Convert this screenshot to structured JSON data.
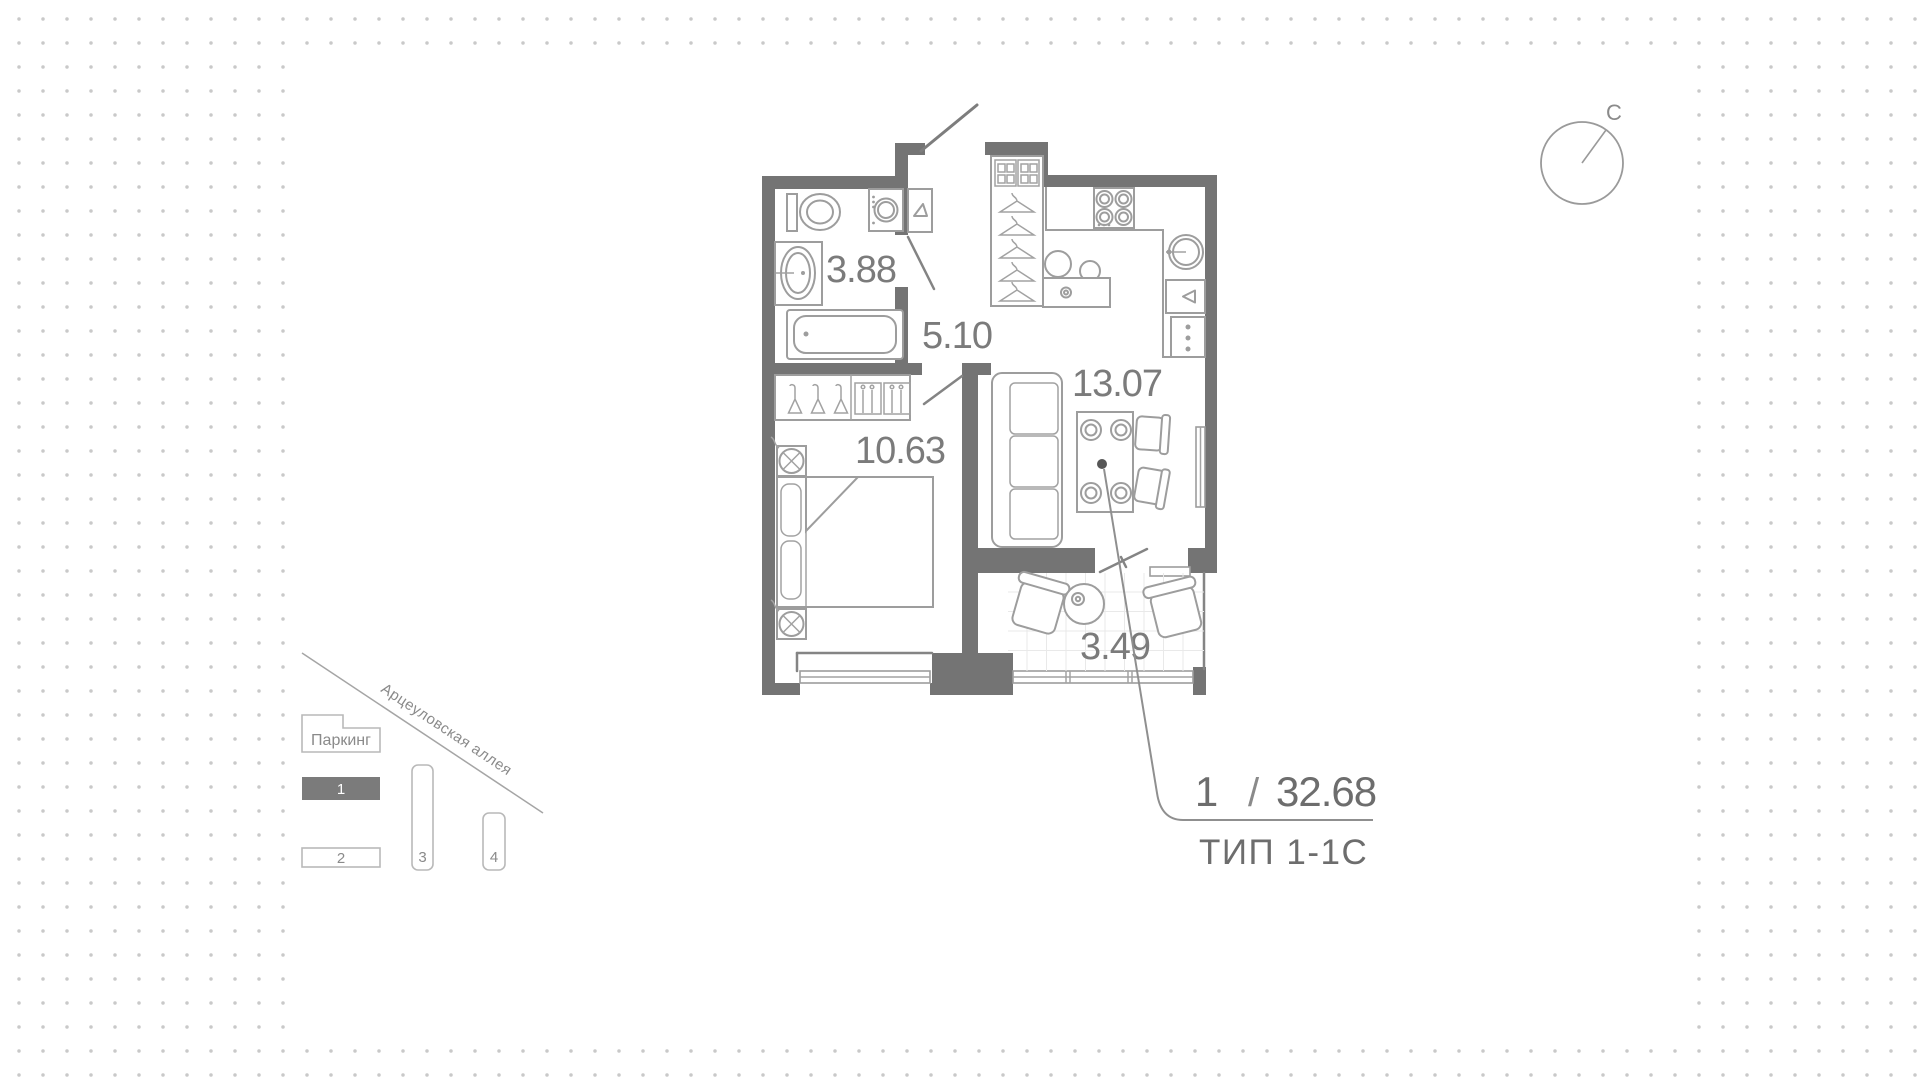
{
  "floor_plan": {
    "compass_north": "С",
    "rooms": [
      {
        "name": "bathroom",
        "area": "3.88"
      },
      {
        "name": "hallway",
        "area": "5.10"
      },
      {
        "name": "kitchen-living",
        "area": "13.07"
      },
      {
        "name": "bedroom",
        "area": "10.63"
      },
      {
        "name": "balcony",
        "area": "3.49"
      }
    ],
    "summary": {
      "rooms_count": "1",
      "divider": "/",
      "total_area": "32.68",
      "plan_type": "ТИП 1-1С"
    }
  },
  "site_plan": {
    "street_name": "Арцеуловская аллея",
    "parking": {
      "label": "Паркинг"
    },
    "buildings": [
      {
        "label": "1",
        "selected": true
      },
      {
        "label": "2",
        "selected": false
      },
      {
        "label": "3",
        "selected": false
      },
      {
        "label": "4",
        "selected": false
      }
    ]
  },
  "colors": {
    "wall": "#747474",
    "furniture_stroke": "#9d9d9d",
    "dots": "#c9c9c9",
    "selected_building_fill": "#7b7b7b",
    "label_text": "#7b7b7b"
  }
}
